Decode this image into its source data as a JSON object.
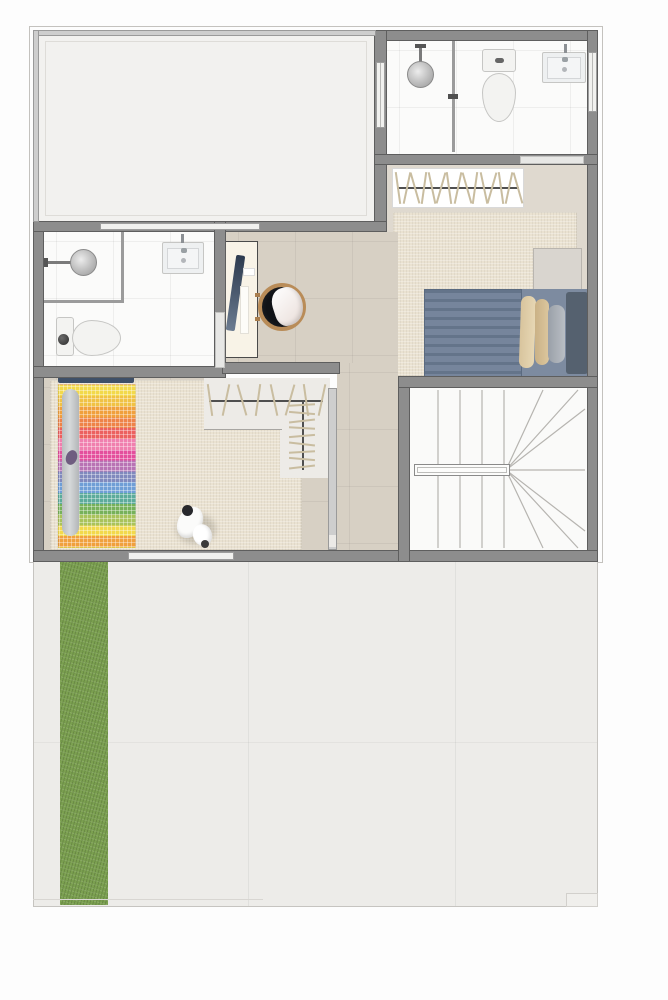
{
  "document": {
    "type": "architectural-floor-plan",
    "view": "top-down",
    "texts": []
  },
  "palette": {
    "wall": "#8d8d8d",
    "wall_dark": "#5e5e5e",
    "thin_wall": "#cecece",
    "outline": "#c4c2be",
    "bath_floor": "#fbfbfa",
    "bedroom_floor": "#dfd9cf",
    "rug": "#eae2d1",
    "hall_floor": "#d7d0c4",
    "terrace_floor": "#f2f1ef",
    "stair_floor": "#fafaf9",
    "patio_floor": "#edece9",
    "grass": "#7ba050",
    "bed_blue": "#76859c",
    "bed_blue_dark": "#64748a",
    "bed_sheet": "#7d8ba0",
    "headboard": "#55616f",
    "pillow_beige": "#d8c49d",
    "pillow_beige2": "#cab186",
    "pillow_gray": "#9aa0a8",
    "kids_headboard": "#3f5068",
    "body_pillow": "#c6c9cb",
    "desk": "#f8f3e7",
    "monitor": "#31415a",
    "chair_wood": "#b98c58",
    "chair_seat": "#17191d",
    "hanger": "#c9bda0",
    "rod": "#4f4f4f",
    "stair_line": "#b6b4b0",
    "porcelain": "#f3f3f1",
    "fixture_border": "#c6c6c4"
  },
  "rooms": [
    {
      "id": "terrace",
      "label": "open terrace room",
      "fixtures": []
    },
    {
      "id": "bathroom-top",
      "label": "bathroom",
      "fixtures": [
        "shower",
        "toilet",
        "sink",
        "glass-divider"
      ]
    },
    {
      "id": "bedroom-right",
      "label": "bedroom",
      "fixtures": [
        "wardrobe-with-hangers",
        "rug",
        "double-bed",
        "pillows",
        "nightstand"
      ]
    },
    {
      "id": "bathroom-left",
      "label": "bathroom",
      "fixtures": [
        "shower",
        "toilet",
        "sink"
      ]
    },
    {
      "id": "hall-study",
      "label": "hall with desk",
      "fixtures": [
        "desk",
        "monitor",
        "papers",
        "chair"
      ]
    },
    {
      "id": "kids-bedroom",
      "label": "bedroom",
      "fixtures": [
        "single-bed-rainbow-blanket",
        "body-pillow",
        "rug",
        "dog"
      ]
    },
    {
      "id": "walk-in-closet",
      "label": "L-shaped closet",
      "fixtures": [
        "hanging-rail-horizontal",
        "hanging-rail-vertical"
      ]
    },
    {
      "id": "staircase",
      "label": "winder staircase",
      "fixtures": [
        "treads",
        "handrail"
      ]
    },
    {
      "id": "patio",
      "label": "ground patio",
      "fixtures": [
        "lawn-strip",
        "paving"
      ]
    }
  ],
  "closets": [
    {
      "target": "wardrobe-hangers",
      "count": 15,
      "orientation": "horizontal"
    },
    {
      "target": "closet-rail-h-hangers",
      "count": 8,
      "orientation": "horizontal"
    },
    {
      "target": "closet-rail-v-hangers",
      "count": 9,
      "orientation": "vertical"
    }
  ],
  "furniture": {
    "kids_bed": {
      "stripe_colors": [
        "#f2d94b",
        "#f0c244",
        "#f0a03d",
        "#ee8348",
        "#ec615f",
        "#f07fae",
        "#e44f9c",
        "#b873b4",
        "#8089bd",
        "#6f9ed6",
        "#5cab9b",
        "#76b15a",
        "#a9c35b",
        "#f2d94b",
        "#f0a03d"
      ]
    }
  },
  "stairs": {
    "type": "winder",
    "size": [
      177,
      162
    ],
    "treads_x": [
      28,
      50,
      72,
      94
    ],
    "pivot": [
      96,
      82
    ],
    "fan_targets": [
      [
        133,
        2
      ],
      [
        168,
        2
      ],
      [
        175,
        21
      ],
      [
        175,
        82
      ],
      [
        175,
        143
      ],
      [
        168,
        160
      ],
      [
        133,
        160
      ]
    ]
  }
}
